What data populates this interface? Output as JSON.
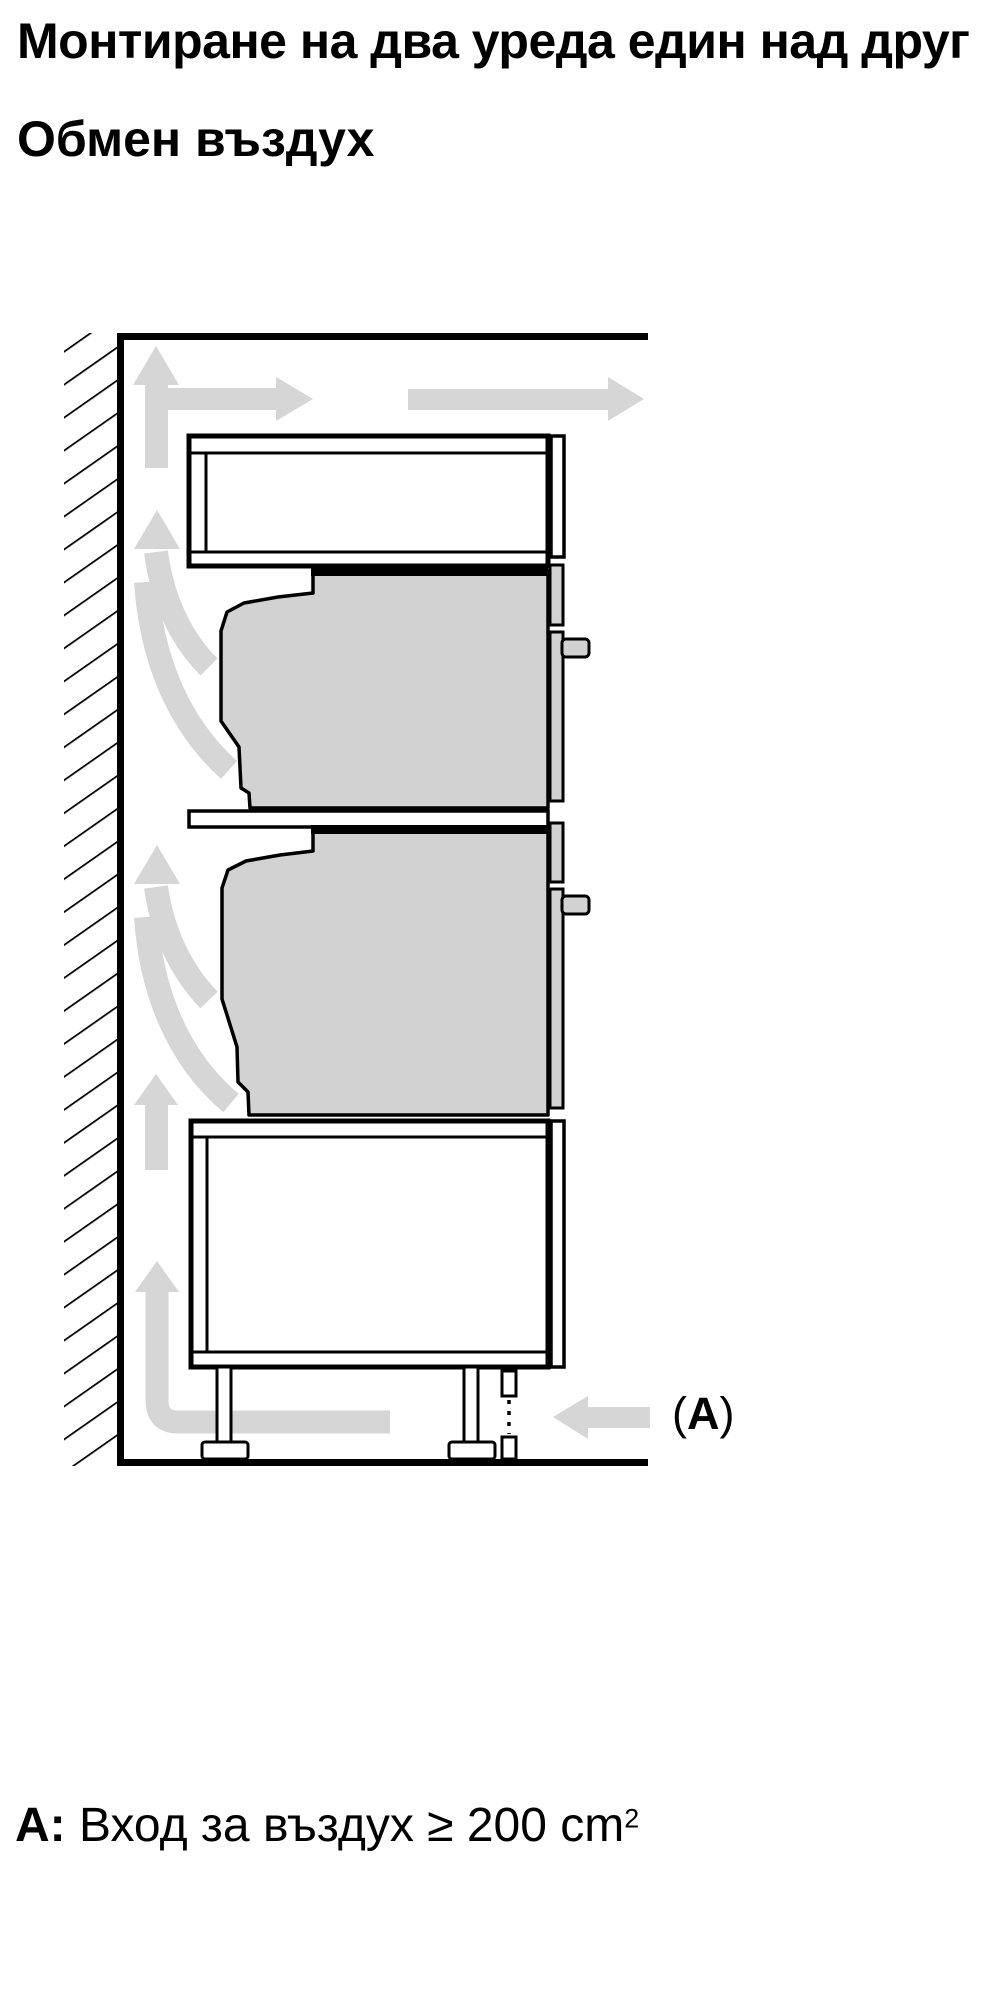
{
  "colors": {
    "ink": "#000000",
    "arrow_gray": "#d6d6d6",
    "appliance_gray": "#d2d2d2",
    "background": "#ffffff"
  },
  "header": {
    "title": "Монтиране на два уреда един над друг",
    "subtitle": "Обмен въздух"
  },
  "diagram": {
    "inlet_label": {
      "open": "(",
      "letter": "A",
      "close": ")"
    }
  },
  "footnote": {
    "label": "А:",
    "body": " Вход за въздух ≥ 200 cm",
    "superscript": "2"
  }
}
